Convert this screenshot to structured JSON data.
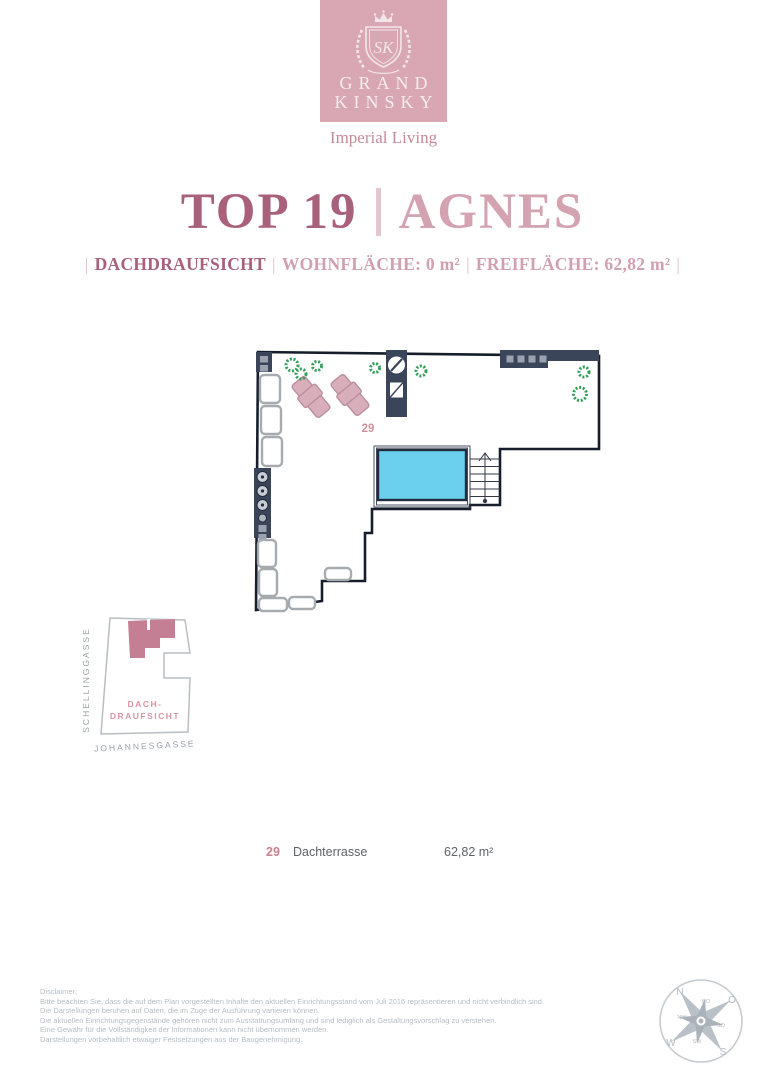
{
  "brand": {
    "line1": "GRAND",
    "line2": "KINSKY",
    "tagline": "Imperial Living"
  },
  "title": {
    "unit": "TOP 19",
    "name": "AGNES"
  },
  "subtitle": {
    "pipe": "|",
    "view": "DACHDRAUFSICHT",
    "living_area": "WOHNFLÄCHE: 0 m²",
    "free_area": "FREIFLÄCHE: 62,82 m²"
  },
  "plan": {
    "room_number": "29"
  },
  "map": {
    "street_left": "SCHELLINGGASSE",
    "street_bottom": "JOHANNESGASSE",
    "label_line1": "DACH-",
    "label_line2": "DRAUFSICHT"
  },
  "legend": {
    "number": "29",
    "room": "Dachterrasse",
    "area": "62,82 m²"
  },
  "disclaimer": {
    "heading": "Disclaimer:",
    "lines": [
      "Bitte beachten Sie, dass die auf dem Plan vorgestellten Inhalte den aktuellen Einrichtungsstand vom Juli 2016 repräsentieren und nicht verbindlich sind.",
      "Die Darstellungen beruhen auf Daten, die im Zuge der Ausführung variieren können.",
      "Die aktuellen Einrichtungsgegenstände gehören nicht zum Ausstattungsumfang und sind lediglich als Gestaltungsvorschlag zu verstehen.",
      "Eine Gewähr für die Vollständigkeit der Informationen kann nicht übernommen werden.",
      "Darstellungen vorbehaltlich etwaiger Festsetzungen aus der Baugenehmigung."
    ]
  },
  "compass": {
    "n": "N",
    "no": "NO",
    "o": "O",
    "so": "SO",
    "s": "S",
    "sw": "SW",
    "w": "W",
    "nw": "NW"
  },
  "colors": {
    "brand_pink": "#d9a7b3",
    "title_dark": "#a9607a",
    "title_light": "#d3a3b2",
    "plan_navy": "#3b455a",
    "pool_blue": "#6ad0ee",
    "plant_green": "#2f9e58",
    "lounger_pink": "#d9aebb",
    "map_unit_pink": "#c57f95",
    "legend_pink": "#c9818f"
  }
}
